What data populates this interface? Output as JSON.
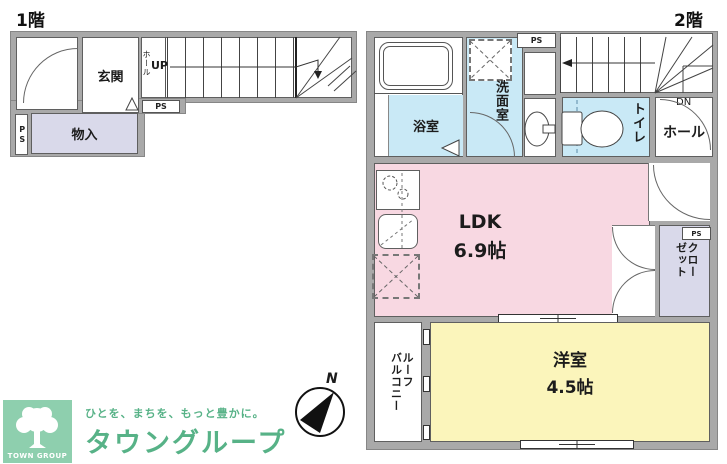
{
  "floor1": {
    "title": "1階",
    "entrance": "玄関",
    "hall": "ホール",
    "up": "UP",
    "ps_box": "PS",
    "ps_side": "PS",
    "storage": "物入"
  },
  "floor2": {
    "title": "2階",
    "bathroom": "浴室",
    "washroom": "洗面室",
    "ps_top": "PS",
    "toilet": "トイレ",
    "down": "DN",
    "hall": "ホール",
    "ldk_label": "LDK",
    "ldk_size": "6.9帖",
    "closet": "クロー\nゼット",
    "ps_closet": "PS",
    "western_room": "洋室",
    "western_size": "4.5帖",
    "balcony": "ルーフ\nバルコニー"
  },
  "compass": {
    "north": "N"
  },
  "branding": {
    "logo": "TOWN GROUP",
    "tagline": "ひとを、まちを、もっと豊かに。",
    "company": "タウングループ"
  },
  "colors": {
    "wall": "#a9a9a9",
    "ldk_pink": "#f8d8e2",
    "western_yellow": "#fbf5bb",
    "wet_blue": "#c9e9f6",
    "storage_lavender": "#d9d9ea",
    "brand_green": "#57b287",
    "logo_bg": "#8ecfae"
  }
}
